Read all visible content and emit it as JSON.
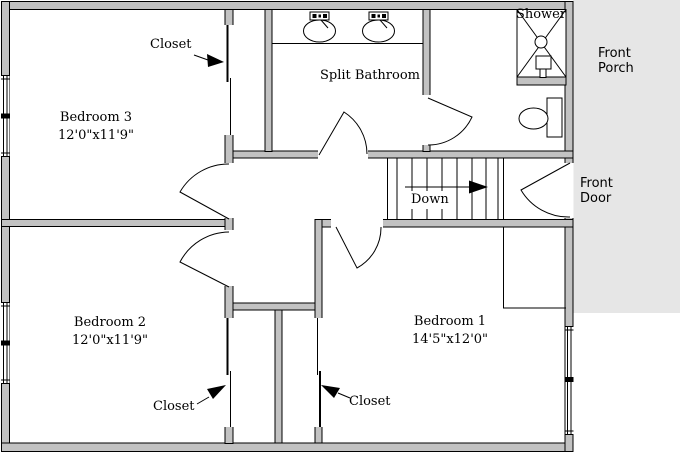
{
  "colors": {
    "wall-fill": "#c2c2c2",
    "porch-fill": "#e6e6e6",
    "line": "#000000",
    "floor": "#ffffff"
  },
  "rooms": {
    "bedroom3": {
      "name": "Bedroom 3",
      "dims": "12'0\"x11'9\""
    },
    "bedroom2": {
      "name": "Bedroom 2",
      "dims": "12'0\"x11'9\""
    },
    "bedroom1": {
      "name": "Bedroom 1",
      "dims": "14'5\"x12'0\""
    },
    "bathroom": {
      "name": "Split Bathroom"
    },
    "shower": {
      "name": "Shower"
    }
  },
  "annotations": {
    "closet_bedroom3": "Closet",
    "closet_bedroom2": "Closet",
    "closet_bedroom1": "Closet",
    "stairs_direction": "Down",
    "front_porch": "Front Porch",
    "front_door": "Front Door"
  }
}
